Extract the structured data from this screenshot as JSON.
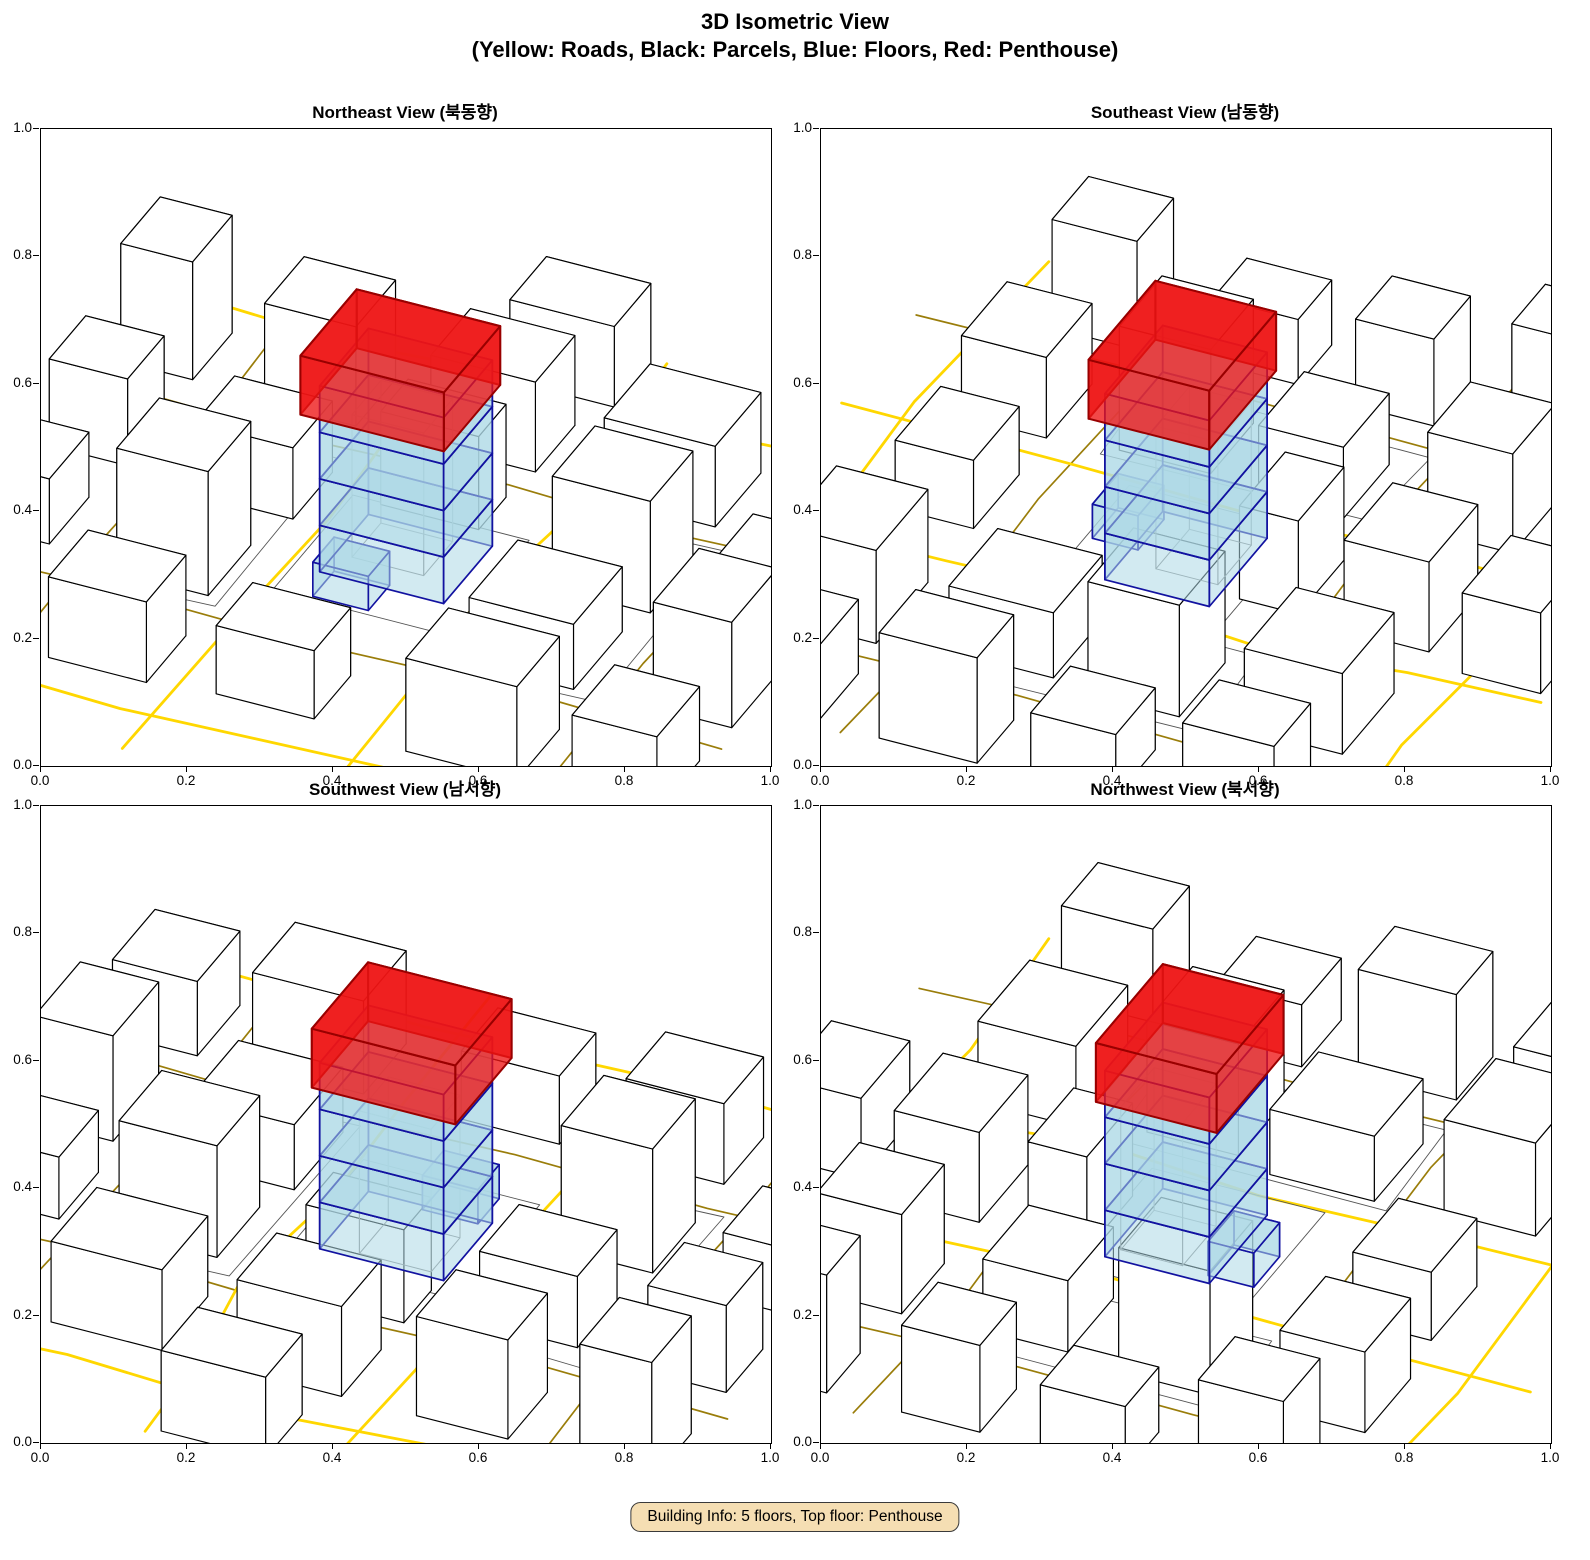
{
  "header": {
    "title_line1": "3D Isometric View",
    "title_line2": "(Yellow: Roads, Black: Parcels, Blue: Floors, Red: Penthouse)"
  },
  "footer": {
    "building_info": "Building Info: 5 floors, Top floor: Penthouse"
  },
  "chart_data": {
    "type": "3d-isometric-city",
    "title": "3D Isometric View",
    "subtitle": "(Yellow: Roads, Black: Parcels, Blue: Floors, Red: Penthouse)",
    "panels": [
      {
        "id": "northeast",
        "title": "Northeast View (북동향)",
        "azimuth_deg": 205
      },
      {
        "id": "southeast",
        "title": "Southeast View (남동향)",
        "azimuth_deg": 295
      },
      {
        "id": "southwest",
        "title": "Southwest View (남서향)",
        "azimuth_deg": 25
      },
      {
        "id": "northwest",
        "title": "Northwest View (북서향)",
        "azimuth_deg": 115
      }
    ],
    "axes": {
      "xlim": [
        0.0,
        1.0
      ],
      "ylim": [
        0.0,
        1.0
      ],
      "xticks": [
        "0.0",
        "0.2",
        "0.4",
        "0.6",
        "0.8",
        "1.0"
      ],
      "yticks": [
        "0.0",
        "0.2",
        "0.4",
        "0.6",
        "0.8",
        "1.0"
      ],
      "grid": false
    },
    "legend": {
      "roads": "Yellow",
      "parcels": "Black",
      "floors": "Blue",
      "penthouse": "Red"
    },
    "building_info": {
      "floors": 5,
      "top_floor": "Penthouse",
      "blue_floor_count": 4
    },
    "colors": {
      "road_major": "#FFD700",
      "road_minor": "#9A7D0A",
      "parcel_edge": "#000000",
      "parcel_fill": "#FFFFFF",
      "ground_line": "#555555",
      "floor_fill": "rgba(173,216,230,0.55)",
      "floor_edge": "#1212A0",
      "penthouse_fill": "rgba(238,21,21,0.78)",
      "penthouse_edge": "#990000",
      "inner_edge": "#8a8a8a",
      "info_bg": "#F5DEB3",
      "info_border": "#3a3a3a"
    },
    "projection": {
      "scale": 72,
      "foreshorten": 0.55,
      "zscale": 62,
      "cx": 365,
      "cy": 430
    },
    "scene": {
      "roads_major": [
        [
          [
            -1.5,
            -6
          ],
          [
            -1.45,
            -3
          ],
          [
            -1.35,
            -0.5
          ],
          [
            -1.6,
            2
          ],
          [
            -1.3,
            4
          ],
          [
            -1.2,
            6
          ]
        ],
        [
          [
            1.55,
            -6
          ],
          [
            1.5,
            -2.5
          ],
          [
            1.4,
            0.5
          ],
          [
            1.55,
            3
          ],
          [
            1.45,
            6
          ]
        ],
        [
          [
            -6,
            4.9
          ],
          [
            -3,
            4.7
          ],
          [
            0,
            4.9
          ],
          [
            3,
            4.6
          ],
          [
            6,
            4.8
          ]
        ],
        [
          [
            -6,
            -5
          ],
          [
            -2,
            -4.9
          ],
          [
            2,
            -5.1
          ],
          [
            6,
            -4.9
          ]
        ]
      ],
      "roads_minor": [
        [
          [
            -6,
            2.3
          ],
          [
            -3.2,
            2.15
          ],
          [
            -0.5,
            2.3
          ],
          [
            2.5,
            2.15
          ],
          [
            6,
            2.3
          ]
        ],
        [
          [
            -6,
            -2.5
          ],
          [
            -3,
            -2.35
          ],
          [
            0.5,
            -2.5
          ],
          [
            3.5,
            -2.4
          ],
          [
            6,
            -2.5
          ]
        ],
        [
          [
            4.0,
            -6
          ],
          [
            4.05,
            -2
          ],
          [
            3.95,
            2
          ],
          [
            4.1,
            6
          ]
        ],
        [
          [
            -4.2,
            -6
          ],
          [
            -4.1,
            -1
          ],
          [
            -4.25,
            3
          ],
          [
            -4.1,
            6
          ]
        ]
      ],
      "ground_lines": [
        [
          [
            -1.35,
            -1.5
          ],
          [
            1.35,
            -1.5
          ],
          [
            1.35,
            1.15
          ],
          [
            -1.35,
            1.15
          ],
          [
            -1.35,
            -1.5
          ]
        ],
        [
          [
            -3.9,
            2.05
          ],
          [
            -1.8,
            1.95
          ],
          [
            -1.75,
            -2.25
          ],
          [
            -3.95,
            -2.15
          ],
          [
            -3.9,
            2.05
          ]
        ],
        [
          [
            1.95,
            1.9
          ],
          [
            3.75,
            2.0
          ],
          [
            3.8,
            -2.3
          ],
          [
            1.9,
            -2.2
          ],
          [
            1.95,
            1.9
          ]
        ]
      ],
      "buildings": [
        [
          -5.2,
          -3.6,
          1.3,
          1.4,
          1.2
        ],
        [
          -5.3,
          -1.2,
          1.2,
          1.5,
          1.7
        ],
        [
          -5.2,
          1.0,
          1.3,
          1.3,
          1.0
        ],
        [
          -5.3,
          3.4,
          1.2,
          1.4,
          1.5
        ],
        [
          -2.9,
          -3.7,
          1.7,
          1.4,
          1.5
        ],
        [
          -2.7,
          -1.2,
          1.6,
          1.6,
          1.05
        ],
        [
          -2.9,
          0.9,
          1.5,
          1.4,
          1.8
        ],
        [
          -2.7,
          3.3,
          1.7,
          1.5,
          1.3
        ],
        [
          0.2,
          -3.6,
          1.5,
          1.2,
          1.1
        ],
        [
          0.15,
          1.55,
          1.5,
          0.9,
          1.5
        ],
        [
          0.1,
          3.4,
          1.6,
          1.3,
          1.45
        ],
        [
          -0.2,
          5.3,
          1.6,
          1.2,
          1.3
        ],
        [
          2.7,
          -3.7,
          1.5,
          1.3,
          1.3
        ],
        [
          2.8,
          -1.3,
          1.4,
          1.4,
          2.0
        ],
        [
          2.6,
          0.9,
          1.5,
          1.3,
          1.15
        ],
        [
          2.75,
          3.4,
          1.4,
          1.3,
          1.6
        ],
        [
          5.1,
          -3.5,
          1.2,
          1.3,
          1.75
        ],
        [
          5.2,
          -1.1,
          1.1,
          1.3,
          1.05
        ],
        [
          5.1,
          1.1,
          1.2,
          1.2,
          1.4
        ],
        [
          5.15,
          3.5,
          1.1,
          1.3,
          1.9
        ]
      ],
      "target": {
        "cx": 0,
        "cy": 0,
        "w": 1.9,
        "d": 1.6,
        "floors": [
          [
            0,
            0.75
          ],
          [
            0.75,
            1.5
          ],
          [
            1.5,
            2.25
          ],
          [
            2.25,
            3.0
          ]
        ],
        "penthouse": {
          "x": 0.05,
          "y": -0.08,
          "w": 2.2,
          "d": 1.85,
          "z0": 2.6,
          "z1": 3.55
        },
        "annex": {
          "x": 0.35,
          "y": -1.05,
          "w": 0.85,
          "d": 0.7,
          "h": 0.55
        },
        "inner": {
          "x": 0.15,
          "y": 0.2,
          "w": 1.1,
          "d": 0.95,
          "h": 2.3
        }
      }
    }
  }
}
